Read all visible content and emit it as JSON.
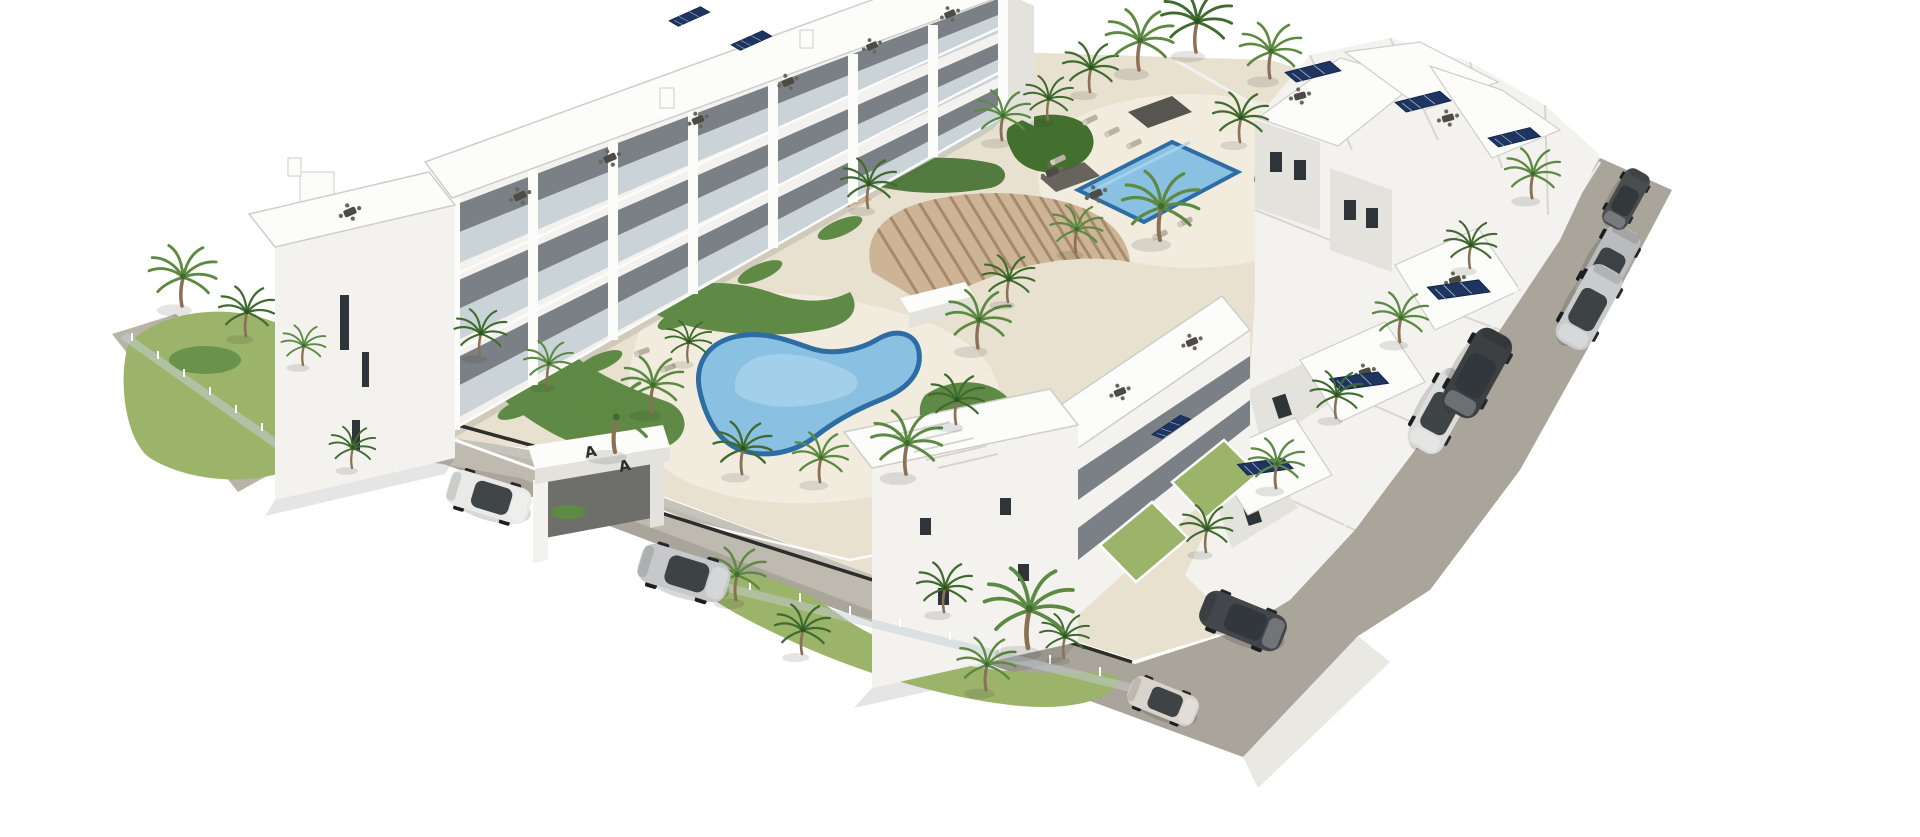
{
  "scene": {
    "kind": "architectural-3d-render",
    "subject": "Aerial 3D rendering of a white Mediterranean apartment complex with two swimming pools, wooden pergola, palm-tree gardens, gated entrance driveway and perimeter road with parked cars",
    "view": "high-angle aerial perspective, white background",
    "visible_text": "A A (marks on entrance-gate roof)"
  },
  "palette": {
    "bg": "#ffffff",
    "sand": "#e8e1d0",
    "sand_light": "#f2ecdf",
    "road": "#aaa59b",
    "road_light": "#b8b3a9",
    "concrete": "#c0bdb3",
    "apron": "#d9d5cc",
    "lawn": "#9cb36a",
    "shrub": "#5f8a46",
    "shrub_dark": "#43702f",
    "frond": "#5d8a42",
    "frond_dark": "#3f6b2e",
    "trunk": "#8a7055",
    "wall": "#f3f2ee",
    "wall_bright": "#fcfcfb",
    "wall_shade": "#e3e2dd",
    "wall_dark": "#cfcec9",
    "recess": "#7a8085",
    "window": "#2f3438",
    "glass": "#c3ced3",
    "rail": "#f1f3f4",
    "pool_rim": "#2e6da4",
    "pool_water": "#8ac0e2",
    "pool_light": "#aad4ec",
    "wood": "#cdb496",
    "wood_slat": "#a58a69",
    "solar": "#1d3560",
    "solar_line": "#c9d4e4",
    "fence_dark": "#2d2d2b",
    "canopy": "#57554f",
    "shadow": "rgba(45,45,38,0.12)"
  },
  "site": {
    "building_rows": [
      {
        "id": "row-left",
        "side": "north-west",
        "blocks": 6,
        "floors": 3,
        "features": [
          "roof terraces with dining sets",
          "glass balconies",
          "tall end tower with narrow windows"
        ]
      },
      {
        "id": "row-top",
        "side": "north-east",
        "blocks": 2,
        "floors": 3,
        "features": [
          "roof terrace furniture",
          "solar panels"
        ]
      },
      {
        "id": "right-cluster",
        "side": "east",
        "blocks": 5,
        "floors": 3,
        "features": [
          "solar panel arrays",
          "walled patio gardens along road"
        ]
      },
      {
        "id": "row-front",
        "side": "south",
        "blocks": 4,
        "floors": 3,
        "features": [
          "large blank end wall",
          "roof pergola slats",
          "fenced lawns"
        ]
      }
    ],
    "amenities": {
      "kidney_pool": {
        "shape": "kidney",
        "location": "central courtyard"
      },
      "lap_pool": {
        "shape": "rectangular",
        "location": "upper terrace"
      },
      "pergola": {
        "material": "wood slats",
        "location": "center"
      },
      "sun_loungers": 8,
      "roof_dining_sets": 15,
      "solar_arrays": 9,
      "palm_trees": 37
    },
    "entrance_gate": {
      "type": "white portal over driveway",
      "roof_marks": [
        "A",
        "A"
      ]
    },
    "roads": {
      "right_road": "wide grey road along east side with parked cars",
      "bottom_driveway": "gated entrance driveway along south side"
    },
    "cars": [
      {
        "id": "white-suv",
        "color": "#e9e9e7",
        "location": "entrance driveway"
      },
      {
        "id": "silver-sedan",
        "color": "#c6c8ca",
        "location": "entrance driveway"
      },
      {
        "id": "beige-city-car",
        "color": "#d8d3cb",
        "location": "south corner road"
      },
      {
        "id": "dark-suv",
        "color": "#43464a",
        "location": "south corner road"
      },
      {
        "id": "white-sedan",
        "color": "#dcdcda",
        "location": "right road middle"
      },
      {
        "id": "dark-sedan",
        "color": "#3c4043",
        "location": "right road middle"
      },
      {
        "id": "silver-suv",
        "color": "#b9bbbd",
        "location": "right road upper"
      },
      {
        "id": "silver-sedan-2",
        "color": "#c9cbcd",
        "location": "right road upper"
      },
      {
        "id": "dark-city-car",
        "color": "#4a4d50",
        "location": "right road top"
      }
    ]
  }
}
